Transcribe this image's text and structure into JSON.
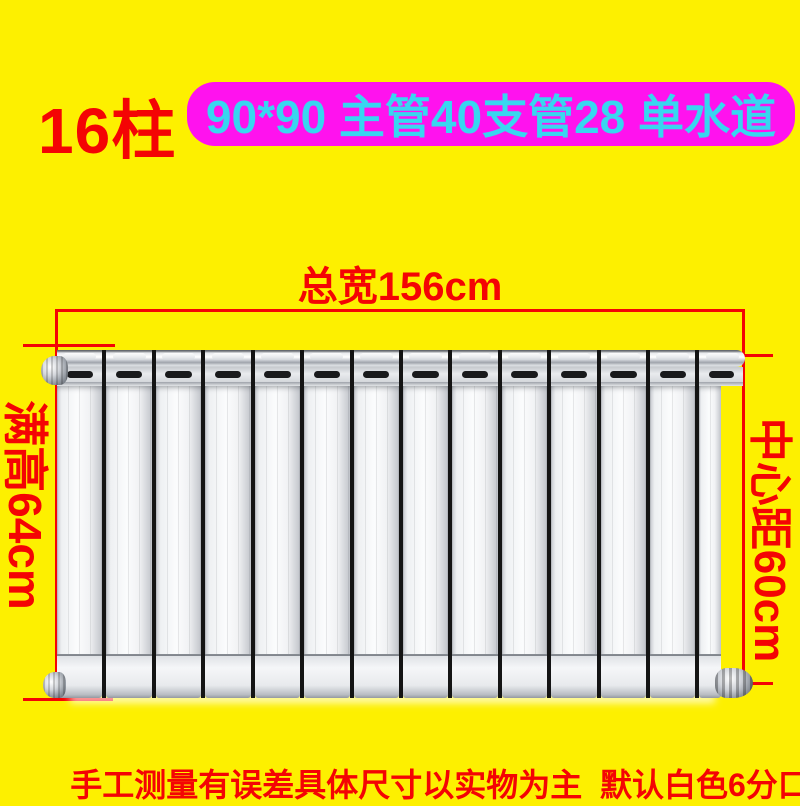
{
  "theme": {
    "background": "#fdf000",
    "accent_red": "#f40404",
    "banner_bg": "#ff12ee",
    "banner_text": "#38d6f0",
    "radiator_dark_gap": "#141414"
  },
  "header": {
    "columns_label": "16柱",
    "spec_banner": "90*90 主管40支管28 单水道"
  },
  "dimensions": {
    "total_width": "总宽156cm",
    "full_height": "满高64cm",
    "center_distance": "中心距60cm"
  },
  "radiator": {
    "column_count": 14,
    "color": "white"
  },
  "footer": {
    "note": "手工测量有误差具体尺寸以实物为主  默认白色6分口"
  }
}
